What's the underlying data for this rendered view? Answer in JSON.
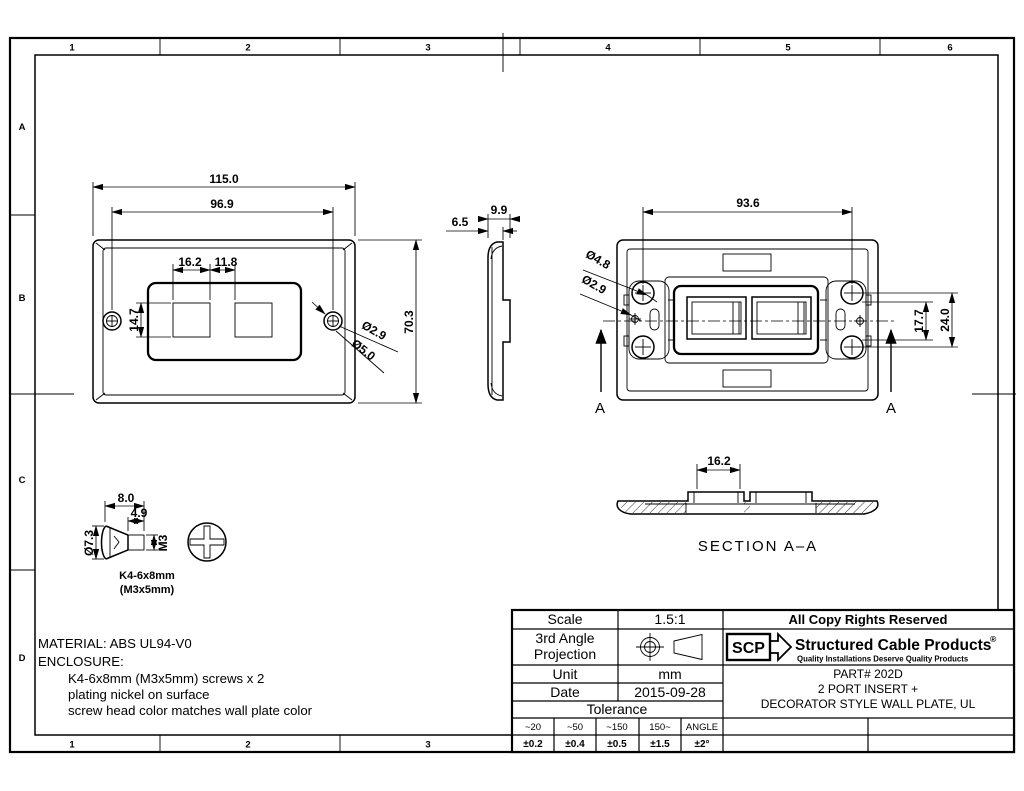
{
  "frame": {
    "top_zones": [
      "1",
      "2",
      "3",
      "4",
      "5",
      "6"
    ],
    "bottom_zones": [
      "1",
      "2",
      "3"
    ],
    "row_zones": [
      "A",
      "B",
      "C",
      "D"
    ]
  },
  "front_view": {
    "overall_width": "115.0",
    "screw_span": "96.9",
    "port_width": "16.2",
    "port_gap": "11.8",
    "port_height": "14.7",
    "overall_height": "70.3",
    "hole_dia": "Ø2.9",
    "head_dia": "Ø5.0"
  },
  "side_view": {
    "thickness": "9.9",
    "front_depth": "6.5"
  },
  "rear_view": {
    "screw_span": "93.6",
    "boss_dia": "Ø4.8",
    "hole_dia": "Ø2.9",
    "opening_height": "17.7",
    "boss_pitch": "24.0",
    "section_letter": "A"
  },
  "section_view": {
    "opening_width": "16.2",
    "title": "SECTION  A–A"
  },
  "screw_detail": {
    "length": "8.0",
    "thread_length": "4.9",
    "head_dia": "Ø7.3",
    "thread_size": "M3",
    "label_line1": "K4-6x8mm",
    "label_line2": "(M3x5mm)"
  },
  "notes": {
    "material": "MATERIAL: ABS UL94-V0",
    "enclosure": "ENCLOSURE:",
    "item1": "K4-6x8mm (M3x5mm)  screws x 2",
    "item2": "plating nickel on surface",
    "item3": "screw head color matches wall plate color"
  },
  "title_block": {
    "scale_label": "Scale",
    "scale_value": "1.5:1",
    "projection_line1": "3rd Angle",
    "projection_line2": "Projection",
    "unit_label": "Unit",
    "unit_value": "mm",
    "date_label": "Date",
    "date_value": "2015-09-28",
    "tolerance_label": "Tolerance",
    "tol_headers": [
      "~20",
      "~50",
      "~150",
      "150~",
      "ANGLE"
    ],
    "tol_values": [
      "±0.2",
      "±0.4",
      "±0.5",
      "±1.5",
      "±2°"
    ],
    "copyright": "All Copy Rights Reserved",
    "brand_abbr": "SCP",
    "brand_name": "Structured Cable Products",
    "brand_mark": "®",
    "brand_tagline": "Quality Installations Deserve Quality Products",
    "part_line1": "PART# 202D",
    "part_line2": "2 PORT INSERT +",
    "part_line3": "DECORATOR STYLE WALL PLATE, UL"
  },
  "colors": {
    "line": "#000000",
    "background": "#ffffff"
  }
}
